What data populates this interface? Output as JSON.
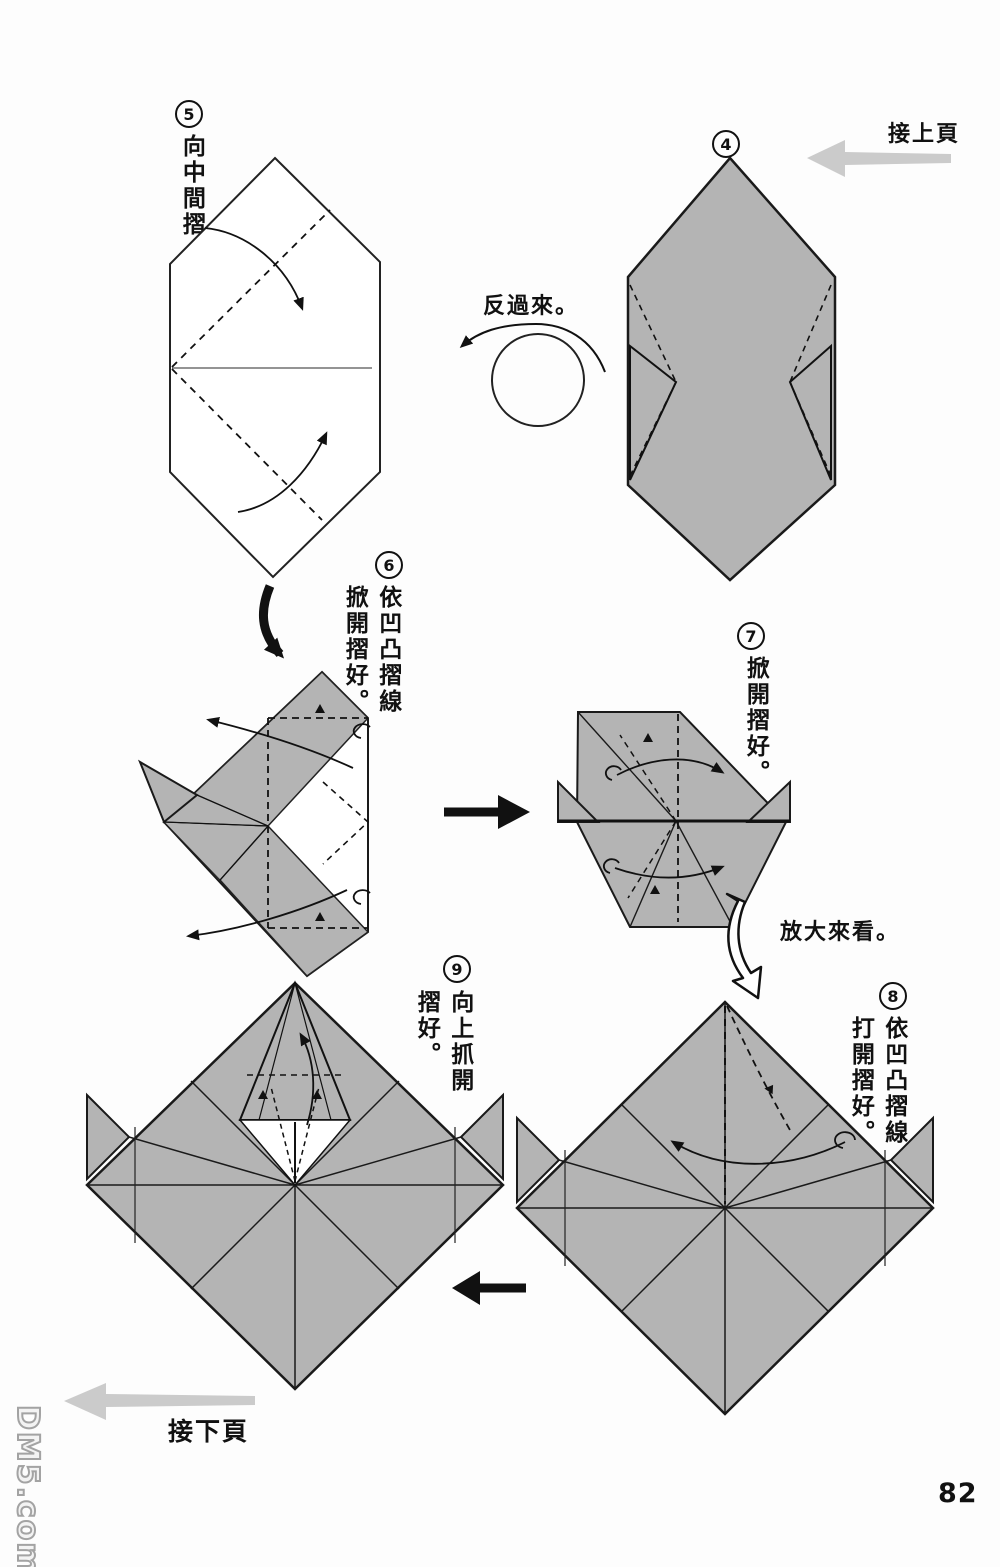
{
  "page": {
    "number": "82",
    "watermark": "DM5.com"
  },
  "nav": {
    "prev": "接上頁",
    "next": "接下頁"
  },
  "notes": {
    "turn_over": "反過來。",
    "enlarge": "放大來看。"
  },
  "steps": {
    "s4": {
      "num": "4"
    },
    "s5": {
      "num": "5",
      "text": "向中間摺。"
    },
    "s6": {
      "num": "6",
      "text_a": "依凹凸摺線",
      "text_b": "掀開摺好。"
    },
    "s7": {
      "num": "7",
      "text": "掀開摺好。"
    },
    "s8": {
      "num": "8",
      "text_a": "依凹凸摺線",
      "text_b": "打開摺好。"
    },
    "s9": {
      "num": "9",
      "text_a": "向上抓開",
      "text_b": "摺好。"
    }
  },
  "colors": {
    "paper_gray": "#b4b4b4",
    "outline": "#1a1a1a",
    "nav_arrow_gray": "#cbcbcb"
  }
}
